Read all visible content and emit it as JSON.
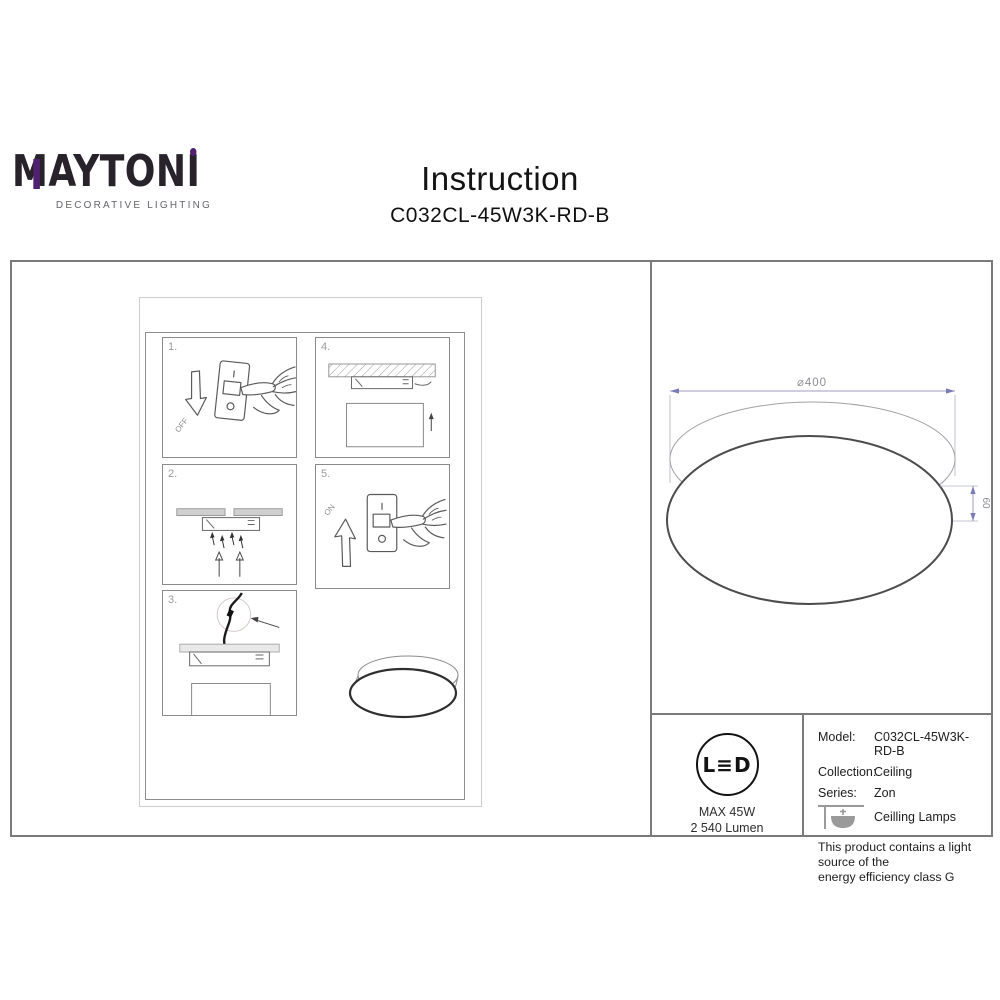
{
  "logo": {
    "letter_m": "M",
    "text_main": "AYTON",
    "text_accent": "I",
    "tagline": "DECORATIVE LIGHTING",
    "accent_color": "#4f2170"
  },
  "header": {
    "title": "Instruction",
    "model": "C032CL-45W3K-RD-B"
  },
  "steps": {
    "panels": [
      {
        "num": "1.",
        "switch_label": "OFF"
      },
      {
        "num": "2."
      },
      {
        "num": "3."
      },
      {
        "num": "4."
      },
      {
        "num": "5.",
        "switch_label": "ON"
      }
    ]
  },
  "drawing": {
    "diameter_label": "⌀400",
    "height_label": "60",
    "dim_color": "#9c9cc0"
  },
  "specs": {
    "led_badge": "L≡D",
    "max_power": "MAX 45W",
    "luminous_flux": "2 540 Lumen"
  },
  "info": {
    "rows": [
      {
        "label": "Model:",
        "value": "C032CL-45W3K-RD-B"
      },
      {
        "label": "Collection:",
        "value": "Ceiling"
      },
      {
        "label": "Series:",
        "value": "Zon"
      }
    ],
    "series_caption": "Ceilling Lamps",
    "energy_note_line1": "This product contains a light source of the",
    "energy_note_line2": "energy efficiency class G"
  }
}
